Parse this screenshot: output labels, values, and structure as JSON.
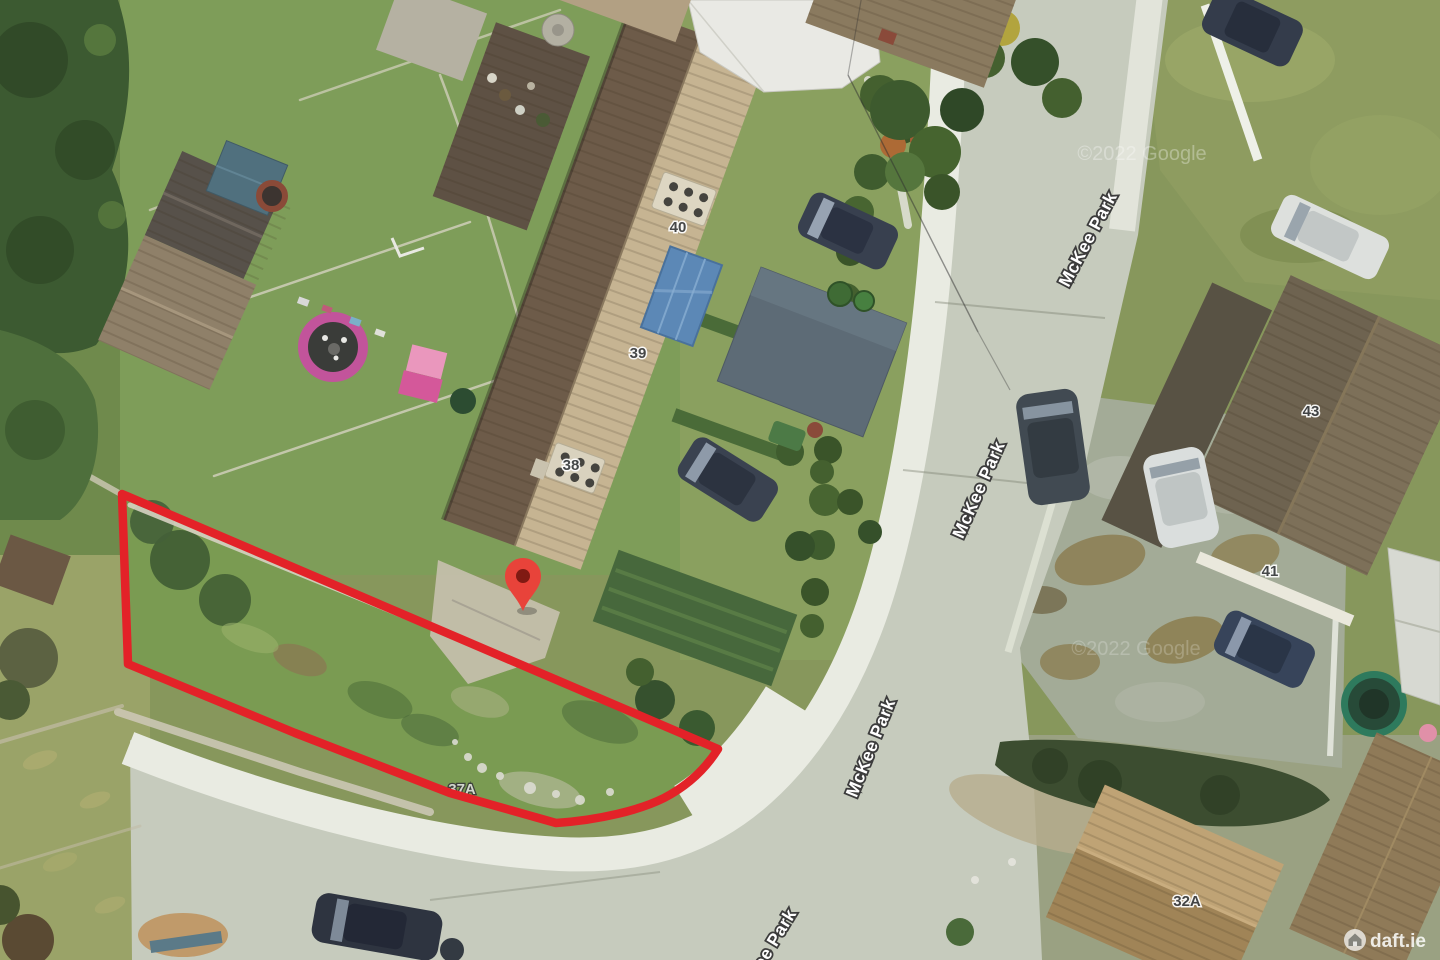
{
  "aerial": {
    "street_name": "McKee Park",
    "house_numbers": {
      "h40": "40",
      "h39": "39",
      "h38": "38",
      "h37a": "37A",
      "h43": "43",
      "h41": "41",
      "h32a": "32A"
    },
    "watermarks": {
      "google": "©2022 Google",
      "daft": "daft.ie"
    },
    "site_outline": {
      "color": "#E32228"
    },
    "marker": {
      "color": "#E8433A",
      "inner_color": "#801A13"
    }
  }
}
